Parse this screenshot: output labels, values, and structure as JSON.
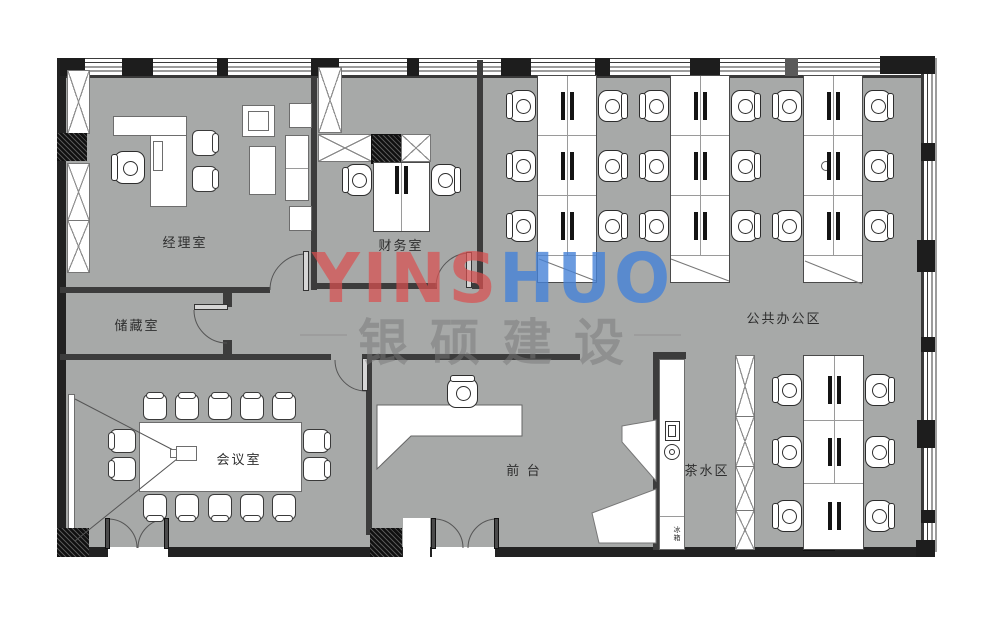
{
  "plan": {
    "rooms": {
      "manager": "经理室",
      "finance": "财务室",
      "storage": "储藏室",
      "meeting": "会议室",
      "reception": "前 台",
      "tea": "茶水区",
      "open_office": "公共办公区"
    },
    "appliances": {
      "fridge": "冰箱"
    },
    "watermark": {
      "latin_1": "YINS",
      "latin_2": "HUO",
      "cn": "银硕建设",
      "red": "#d95050",
      "blue": "#4682d7"
    },
    "counts": {
      "meeting_chairs": 14,
      "workstation_chairs_open_office": 23,
      "finance_chairs": 2
    },
    "colors": {
      "floor": "#a7a9a8",
      "wall": "#222222"
    }
  }
}
